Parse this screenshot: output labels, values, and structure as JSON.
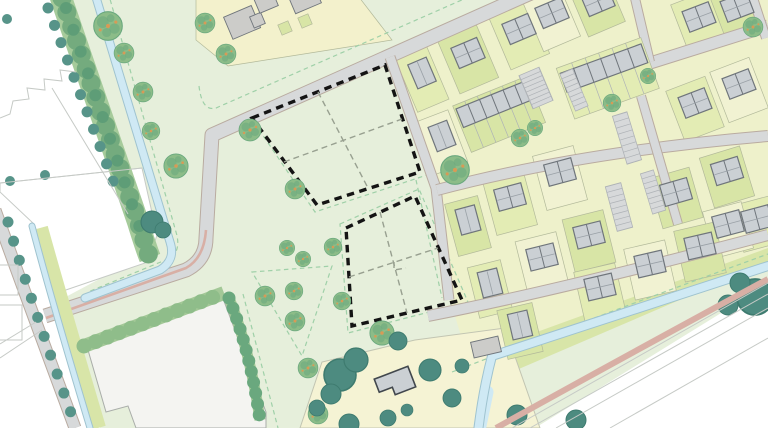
{
  "meta": {
    "title": "Residential development site plan",
    "kind": "vector site plan / masterplan map",
    "visible_text": []
  },
  "colors": {
    "bg": "#ffffff",
    "existing_outline": "#c6cac6",
    "park": "#e6efdb",
    "housing_base": "#eef1cb",
    "lots_yellow": "#f3f1cc",
    "farm": "#f5f3d4",
    "farm_line": "#c2c5b2",
    "parcel_a": "#e3ecb4",
    "parcel_b": "#d8e5a6",
    "parcel_c": "#f1f2d2",
    "parcel_line": "#b2b99a",
    "verge": "#d8e5a8",
    "road": "#d7d9da",
    "road_casing": "#b9aba0",
    "road_pink": "#d8afa5",
    "water": "#cfe9f4",
    "water_casing": "#9fc3cf",
    "pad": "#f4f4f1",
    "pad_stroke": "#a9ada9",
    "strip_base": "#a6cb9b",
    "strip_blob": "#74ab7e",
    "strip_blob_dark": "#5e9d77",
    "hedge_base": "#a3c897",
    "hedge": "#8fbd8a",
    "caterpillar": "#6aa87e",
    "tree_dot": "#579489",
    "tree_dark": "#4d8b80",
    "tree_dark_stroke": "#3e7b6f",
    "tree_light": "#8cbc88",
    "tree_light_dark": "#69a87e",
    "tree_orange": "#d89a56",
    "house": "#cbd0d4",
    "house_stroke": "#6f757b",
    "house_ridge": "#9aa1a7",
    "building_gray": "#ccccc9",
    "farmhouse_stroke": "#41474d",
    "court_stroke": "#aeb2b6",
    "dash_black": "#141414",
    "dash_gray": "#98a090",
    "dash_green": "#9fd0a8"
  },
  "features": [
    {
      "name": "development-parcel-outline",
      "style": "thick black dashed boundary",
      "count": 2
    },
    {
      "name": "parcel-subdivision-line",
      "style": "gray dashed internal split lines"
    },
    {
      "name": "proposed-house",
      "variants": [
        "detached",
        "semi-detached-pair",
        "terrace-row"
      ]
    },
    {
      "name": "parking-court",
      "style": "striped bays on gray"
    },
    {
      "name": "canal",
      "style": "light blue watercourse"
    },
    {
      "name": "hedgerow",
      "style": "scalloped green tree band"
    },
    {
      "name": "street-tree",
      "style": "dark green dot"
    },
    {
      "name": "park-tree",
      "style": "light feathery green blob with orange speckles"
    },
    {
      "name": "existing-context",
      "style": "white with thin gray outlines"
    },
    {
      "name": "footpath",
      "style": "pink strip"
    },
    {
      "name": "farmstead",
      "style": "pale yellow yard with dark-outlined farmhouse"
    }
  ]
}
